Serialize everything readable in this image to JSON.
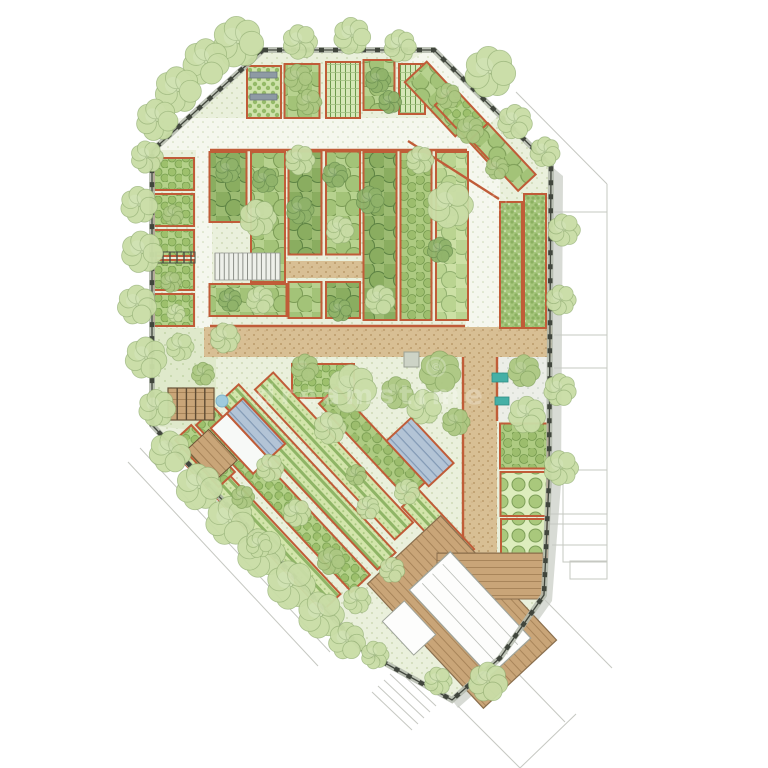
{
  "title": "Garden site plan illustration",
  "watermark": {
    "text": "dreamstime",
    "symbol": "©",
    "color": "#ffffff",
    "opacity": 0.24,
    "x": 372,
    "y": 404,
    "font_size": 27,
    "letter_spacing": 5,
    "ring": {
      "x": 436,
      "y": 367,
      "r": 9
    },
    "ring2": {
      "x": 498,
      "y": 202,
      "r": 8
    }
  },
  "palette": {
    "background": "#ffffff",
    "bed_border": "#c05c38",
    "fence_dark": "#41463d",
    "fence_rail": "#b3b8ab",
    "shadow": "#d8dbd5",
    "neighbor_line": "#c6c8c2",
    "water": "#9fcbdd",
    "bench_teal": "#45b0a6",
    "stair_line": "#8d9089",
    "roof_white": "#fdfdfc",
    "roof_line": "#b9bcb6",
    "wood_edge": "#8a6f4e",
    "shed_gray": "#cdd3c6",
    "tree_tones": [
      [
        "#c9dda6",
        "#90ad70"
      ],
      [
        "#adc883",
        "#7f9f5a"
      ],
      [
        "#90b36a",
        "#61884a"
      ]
    ]
  },
  "site": {
    "outline": [
      [
        263,
        50
      ],
      [
        434,
        50
      ],
      [
        551,
        166
      ],
      [
        549,
        480
      ],
      [
        544,
        595
      ],
      [
        500,
        658
      ],
      [
        452,
        700
      ],
      [
        365,
        652
      ],
      [
        152,
        425
      ],
      [
        152,
        151
      ]
    ],
    "shadow_poly": [
      [
        551,
        166
      ],
      [
        549,
        480
      ],
      [
        544,
        595
      ],
      [
        500,
        658
      ],
      [
        452,
        700
      ],
      [
        458,
        708
      ],
      [
        506,
        666
      ],
      [
        552,
        601
      ],
      [
        561,
        484
      ],
      [
        563,
        176
      ]
    ]
  },
  "neighbors": {
    "lines": [
      [
        [
          516,
          92
        ],
        [
          607,
          184
        ]
      ],
      [
        [
          607,
          184
        ],
        [
          607,
          545
        ]
      ],
      [
        [
          552,
          212
        ],
        [
          607,
          212
        ]
      ],
      [
        [
          554,
          335
        ],
        [
          607,
          335
        ]
      ],
      [
        [
          554,
          368
        ],
        [
          607,
          368
        ]
      ],
      [
        [
          516,
          514
        ],
        [
          607,
          514
        ]
      ],
      [
        [
          520,
          524
        ],
        [
          607,
          524
        ]
      ],
      [
        [
          552,
          545
        ],
        [
          607,
          545
        ]
      ],
      [
        [
          545,
          600
        ],
        [
          612,
          668
        ]
      ],
      [
        [
          505,
          660
        ],
        [
          565,
          722
        ]
      ],
      [
        [
          458,
          706
        ],
        [
          520,
          768
        ]
      ],
      [
        [
          520,
          768
        ],
        [
          576,
          714
        ]
      ],
      [
        [
          140,
          448
        ],
        [
          330,
          652
        ]
      ],
      [
        [
          128,
          462
        ],
        [
          318,
          666
        ]
      ]
    ],
    "rects": [
      [
        570,
        561,
        37,
        18
      ],
      [
        563,
        470,
        44,
        92
      ]
    ],
    "stair_lines": [
      [
        [
          396,
          668
        ],
        [
          436,
          706
        ]
      ],
      [
        [
          390,
          674
        ],
        [
          430,
          712
        ]
      ],
      [
        [
          384,
          680
        ],
        [
          424,
          718
        ]
      ],
      [
        [
          378,
          686
        ],
        [
          418,
          724
        ]
      ],
      [
        [
          372,
          692
        ],
        [
          412,
          730
        ]
      ]
    ]
  },
  "paths": [
    {
      "kind": "poly",
      "tex": "lawn",
      "name": "west-lawn",
      "pts": [
        [
          152,
          328
        ],
        [
          216,
          328
        ],
        [
          216,
          432
        ],
        [
          152,
          426
        ]
      ]
    },
    {
      "kind": "rect",
      "tex": "path",
      "name": "north-path",
      "x": 156,
      "y": 118,
      "w": 310,
      "h": 32
    },
    {
      "kind": "poly",
      "tex": "path",
      "name": "northeast-diagonal-path",
      "pts": [
        [
          408,
          62
        ],
        [
          430,
          48
        ],
        [
          498,
          116
        ],
        [
          474,
          138
        ]
      ]
    },
    {
      "kind": "rect",
      "tex": "path",
      "name": "north-south-path",
      "x": 466,
      "y": 140,
      "w": 34,
      "h": 190
    },
    {
      "kind": "rect",
      "tex": "path",
      "name": "west-path",
      "x": 196,
      "y": 140,
      "w": 16,
      "h": 188
    },
    {
      "kind": "rect",
      "tex": "tan",
      "name": "main-east-west-path",
      "x": 204,
      "y": 327,
      "w": 348,
      "h": 30
    },
    {
      "kind": "rect",
      "tex": "tan",
      "name": "south-path",
      "x": 463,
      "y": 357,
      "w": 34,
      "h": 198
    },
    {
      "kind": "rect",
      "tex": "tan",
      "name": "cross-path",
      "x": 283,
      "y": 261,
      "w": 80,
      "h": 17
    },
    {
      "kind": "rect",
      "tex": "paving",
      "name": "courtyard-paving",
      "x": 497,
      "y": 357,
      "w": 52,
      "h": 64
    }
  ],
  "red_lines": [
    [
      [
        210,
        150
      ],
      [
        467,
        150
      ]
    ],
    [
      [
        408,
        141
      ],
      [
        499,
        199
      ]
    ],
    [
      [
        210,
        326
      ],
      [
        465,
        326
      ]
    ],
    [
      [
        463,
        357
      ],
      [
        463,
        553
      ]
    ],
    [
      [
        497,
        357
      ],
      [
        497,
        421
      ]
    ]
  ],
  "beds": [
    {
      "cx": 264,
      "cy": 92,
      "w": 34,
      "h": 52,
      "rot": 0,
      "tex": "plots",
      "name": "bed-top-1"
    },
    {
      "cx": 302,
      "cy": 91,
      "w": 35,
      "h": 54,
      "rot": 0,
      "tex": "canopyM",
      "name": "bed-top-2"
    },
    {
      "cx": 343,
      "cy": 90,
      "w": 34,
      "h": 56,
      "rot": 0,
      "tex": "grid",
      "name": "bed-top-trellis"
    },
    {
      "cx": 379,
      "cy": 85,
      "w": 31,
      "h": 50,
      "rot": 0,
      "tex": "canopyM",
      "name": "bed-top-3"
    },
    {
      "cx": 412,
      "cy": 89,
      "w": 26,
      "h": 50,
      "rot": 0,
      "tex": "grid",
      "name": "bed-top-trellis-2"
    },
    {
      "cx": 174,
      "cy": 174,
      "w": 40,
      "h": 32,
      "rot": 0,
      "tex": "shrub",
      "name": "west-bed-1"
    },
    {
      "cx": 174,
      "cy": 210,
      "w": 40,
      "h": 32,
      "rot": 0,
      "tex": "shrub",
      "name": "west-bed-2"
    },
    {
      "cx": 174,
      "cy": 243,
      "w": 40,
      "h": 26,
      "rot": 0,
      "tex": "shrub",
      "name": "west-bed-3"
    },
    {
      "cx": 174,
      "cy": 275,
      "w": 40,
      "h": 30,
      "rot": 0,
      "tex": "shrub",
      "name": "west-bed-4"
    },
    {
      "cx": 174,
      "cy": 310,
      "w": 40,
      "h": 32,
      "rot": 0,
      "tex": "shrub",
      "name": "west-bed-5"
    },
    {
      "cx": 228,
      "cy": 187,
      "w": 37,
      "h": 70,
      "rot": 0,
      "tex": "canopyD",
      "name": "orchard-col-1"
    },
    {
      "cx": 248,
      "cy": 300,
      "w": 77,
      "h": 32,
      "rot": 0,
      "tex": "canopyM",
      "name": "orchard-col-1b"
    },
    {
      "cx": 268,
      "cy": 217,
      "w": 34,
      "h": 130,
      "rot": 0,
      "tex": "canopyM",
      "name": "orchard-col-2"
    },
    {
      "cx": 305,
      "cy": 203,
      "w": 33,
      "h": 103,
      "rot": 0,
      "tex": "canopyD",
      "name": "orchard-col-3"
    },
    {
      "cx": 305,
      "cy": 300,
      "w": 33,
      "h": 36,
      "rot": 0,
      "tex": "canopyM",
      "name": "orchard-col-3b"
    },
    {
      "cx": 343,
      "cy": 203,
      "w": 34,
      "h": 103,
      "rot": 0,
      "tex": "canopyM",
      "name": "orchard-col-4"
    },
    {
      "cx": 343,
      "cy": 300,
      "w": 34,
      "h": 36,
      "rot": 0,
      "tex": "canopyD",
      "name": "orchard-col-4b"
    },
    {
      "cx": 380,
      "cy": 236,
      "w": 33,
      "h": 168,
      "rot": 0,
      "tex": "canopyD",
      "name": "orchard-col-5"
    },
    {
      "cx": 416,
      "cy": 236,
      "w": 31,
      "h": 168,
      "rot": 0,
      "tex": "canopyS",
      "name": "orchard-col-6"
    },
    {
      "cx": 452,
      "cy": 236,
      "w": 32,
      "h": 168,
      "rot": 0,
      "tex": "canopyL",
      "name": "orchard-col-7"
    },
    {
      "cx": 511,
      "cy": 265,
      "w": 22,
      "h": 126,
      "rot": 0,
      "tex": "fine",
      "name": "east-orchard-1"
    },
    {
      "cx": 535,
      "cy": 261,
      "w": 22,
      "h": 134,
      "rot": 0,
      "tex": "fine",
      "name": "east-orchard-2"
    },
    {
      "cx": 441,
      "cy": 99,
      "w": 74,
      "h": 30,
      "rot": 47,
      "tex": "canopyM",
      "name": "ne-diag-bed-1"
    },
    {
      "cx": 473,
      "cy": 127,
      "w": 84,
      "h": 26,
      "rot": 47,
      "tex": "shrub",
      "name": "ne-diag-bed-2"
    },
    {
      "cx": 503,
      "cy": 157,
      "w": 70,
      "h": 24,
      "rot": 47,
      "tex": "canopyM",
      "name": "ne-diag-bed-3"
    },
    {
      "cx": 323,
      "cy": 381,
      "w": 62,
      "h": 34,
      "rot": 0,
      "tex": "shrub",
      "name": "mid-bed"
    },
    {
      "cx": 524,
      "cy": 446,
      "w": 48,
      "h": 45,
      "rot": 0,
      "tex": "canopyS",
      "name": "east-bed-1"
    },
    {
      "cx": 524,
      "cy": 494,
      "w": 47,
      "h": 44,
      "rot": 0,
      "tex": "bushes",
      "name": "east-bed-2"
    },
    {
      "cx": 524,
      "cy": 538,
      "w": 46,
      "h": 38,
      "rot": 0,
      "tex": "bushes",
      "name": "east-bed-3"
    },
    {
      "cx": 258,
      "cy": 524,
      "w": 215,
      "h": 25,
      "rot": 47,
      "tex": "rows",
      "name": "allotment-row-1"
    },
    {
      "cx": 283,
      "cy": 500,
      "w": 228,
      "h": 25,
      "rot": 47,
      "tex": "shrub",
      "name": "allotment-row-2"
    },
    {
      "cx": 308,
      "cy": 477,
      "w": 230,
      "h": 25,
      "rot": 47,
      "tex": "rows",
      "name": "allotment-row-3"
    },
    {
      "cx": 334,
      "cy": 456,
      "w": 205,
      "h": 25,
      "rot": 47,
      "tex": "rows",
      "name": "allotment-row-4"
    },
    {
      "cx": 372,
      "cy": 443,
      "w": 130,
      "h": 24,
      "rot": 47,
      "tex": "canopyS",
      "name": "allotment-row-5"
    },
    {
      "cx": 205,
      "cy": 456,
      "w": 64,
      "h": 22,
      "rot": 47,
      "tex": "shrub",
      "name": "allotment-row-west"
    },
    {
      "cx": 438,
      "cy": 528,
      "w": 80,
      "h": 24,
      "rot": 47,
      "tex": "rows",
      "name": "allotment-row-east"
    },
    {
      "cx": 436,
      "cy": 585,
      "w": 46,
      "h": 22,
      "rot": 47,
      "tex": "rowsB",
      "name": "deck-planter"
    }
  ],
  "stairs": {
    "x": 215,
    "y": 253,
    "w": 65,
    "h": 27,
    "treads": 14
  },
  "structures": {
    "deck": {
      "cx": 462,
      "cy": 612,
      "w": 170,
      "h": 100,
      "rot": 47,
      "name": "main-deck"
    },
    "deck_steps": {
      "x": 437,
      "y": 553,
      "w": 106,
      "h": 46,
      "name": "deck-steps"
    },
    "building": {
      "cx": 470,
      "cy": 614,
      "w": 118,
      "h": 56,
      "rot": 47,
      "name": "pavilion-roof"
    },
    "annex": {
      "cx": 409,
      "cy": 628,
      "w": 46,
      "h": 30,
      "rot": 47,
      "name": "pavilion-annex"
    },
    "greenhouse_mixed": {
      "cx": 248,
      "cy": 436,
      "w": 62,
      "h": 44,
      "rot": 47,
      "name": "greenhouse-west"
    },
    "greenhouse_glass": {
      "cx": 420,
      "cy": 452,
      "w": 62,
      "h": 34,
      "rot": 47,
      "name": "greenhouse-east"
    },
    "platform1": {
      "x": 168,
      "y": 388,
      "w": 46,
      "h": 32,
      "name": "lawn-deck"
    },
    "platform2": {
      "cx": 212,
      "cy": 455,
      "w": 42,
      "h": 30,
      "rot": 47,
      "name": "allotment-deck"
    },
    "pergola": {
      "x": 154,
      "y": 252,
      "w": 41,
      "h": 11,
      "name": "pergola"
    },
    "shed": {
      "x": 404,
      "y": 352,
      "w": 15,
      "h": 15,
      "name": "shed"
    },
    "cold_frames": [
      {
        "x": 250,
        "y": 72,
        "w": 27,
        "h": 6
      },
      {
        "x": 250,
        "y": 94,
        "w": 27,
        "h": 6
      }
    ]
  },
  "benches": [
    {
      "x": 492,
      "y": 373,
      "w": 16,
      "h": 9
    },
    {
      "x": 495,
      "y": 397,
      "w": 14,
      "h": 8
    }
  ],
  "pond": {
    "cx": 222,
    "cy": 401,
    "r": 6
  },
  "trees": [
    [
      238,
      42,
      22,
      0
    ],
    [
      206,
      62,
      20,
      0
    ],
    [
      178,
      90,
      20,
      0
    ],
    [
      157,
      120,
      18,
      0
    ],
    [
      147,
      157,
      14,
      0
    ],
    [
      139,
      205,
      16,
      0
    ],
    [
      142,
      252,
      18,
      0
    ],
    [
      137,
      305,
      17,
      0
    ],
    [
      146,
      358,
      18,
      0
    ],
    [
      157,
      408,
      16,
      0
    ],
    [
      170,
      452,
      18,
      0
    ],
    [
      199,
      487,
      20,
      0
    ],
    [
      230,
      521,
      21,
      0
    ],
    [
      261,
      553,
      21,
      0
    ],
    [
      291,
      585,
      21,
      0
    ],
    [
      321,
      615,
      20,
      0
    ],
    [
      347,
      641,
      16,
      0
    ],
    [
      300,
      42,
      15,
      0
    ],
    [
      352,
      36,
      16,
      0
    ],
    [
      400,
      46,
      14,
      0
    ],
    [
      490,
      72,
      22,
      0
    ],
    [
      515,
      122,
      15,
      0
    ],
    [
      545,
      152,
      13,
      0
    ],
    [
      564,
      230,
      14,
      0
    ],
    [
      561,
      300,
      13,
      0
    ],
    [
      560,
      390,
      14,
      0
    ],
    [
      561,
      468,
      15,
      0
    ],
    [
      488,
      682,
      17,
      0
    ],
    [
      438,
      681,
      12,
      0
    ],
    [
      375,
      655,
      12,
      0
    ],
    [
      258,
      218,
      16,
      0
    ],
    [
      450,
      205,
      20,
      0
    ],
    [
      225,
      338,
      13,
      0
    ],
    [
      305,
      368,
      12,
      1
    ],
    [
      352,
      389,
      21,
      0
    ],
    [
      397,
      393,
      14,
      1
    ],
    [
      330,
      428,
      14,
      0
    ],
    [
      440,
      372,
      18,
      1
    ],
    [
      424,
      407,
      15,
      0
    ],
    [
      456,
      422,
      12,
      1
    ],
    [
      524,
      371,
      14,
      1
    ],
    [
      527,
      415,
      16,
      0
    ],
    [
      180,
      347,
      12,
      0
    ],
    [
      203,
      374,
      10,
      1
    ],
    [
      270,
      468,
      12,
      0
    ],
    [
      243,
      497,
      10,
      1
    ],
    [
      297,
      513,
      12,
      0
    ],
    [
      259,
      545,
      11,
      0
    ],
    [
      331,
      561,
      12,
      1
    ],
    [
      368,
      508,
      10,
      0
    ],
    [
      407,
      492,
      11,
      0
    ],
    [
      356,
      475,
      9,
      1
    ],
    [
      392,
      570,
      11,
      0
    ],
    [
      357,
      600,
      12,
      0
    ],
    [
      173,
      215,
      9,
      1
    ],
    [
      171,
      282,
      9,
      1
    ],
    [
      176,
      313,
      8,
      0
    ],
    [
      300,
      160,
      13,
      0
    ],
    [
      340,
      230,
      12,
      0
    ],
    [
      260,
      300,
      12,
      0
    ],
    [
      380,
      300,
      13,
      0
    ],
    [
      420,
      160,
      12,
      0
    ],
    [
      470,
      130,
      12,
      1
    ],
    [
      448,
      96,
      11,
      1
    ],
    [
      497,
      168,
      10,
      1
    ],
    [
      298,
      78,
      12,
      1
    ],
    [
      309,
      102,
      11,
      1
    ],
    [
      378,
      80,
      11,
      2
    ],
    [
      390,
      102,
      10,
      2
    ],
    [
      228,
      170,
      11,
      2
    ],
    [
      265,
      180,
      11,
      2
    ],
    [
      300,
      210,
      12,
      2
    ],
    [
      335,
      175,
      11,
      2
    ],
    [
      370,
      200,
      12,
      2
    ],
    [
      230,
      300,
      10,
      2
    ],
    [
      340,
      310,
      10,
      2
    ],
    [
      440,
      250,
      11,
      2
    ]
  ]
}
